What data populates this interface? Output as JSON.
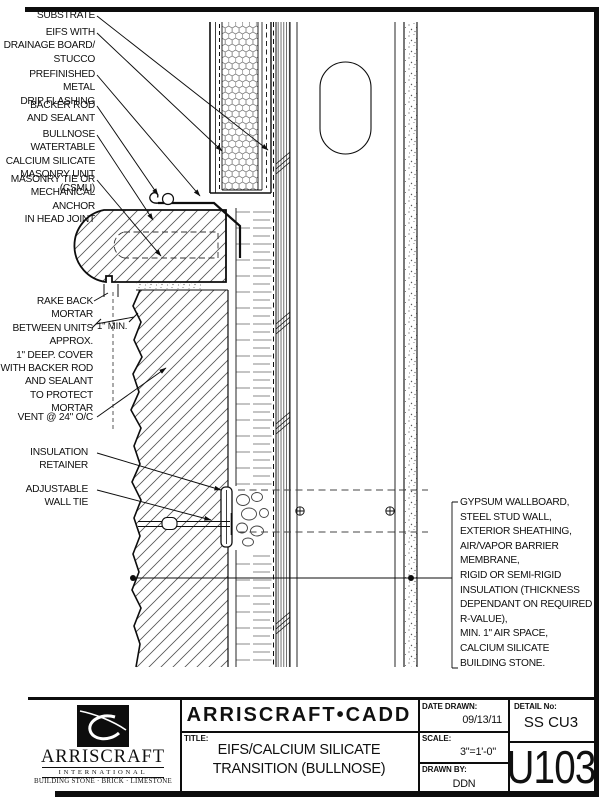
{
  "colors": {
    "ink": "#0d0d0d",
    "paper": "#ffffff",
    "hatch": "#555555"
  },
  "callouts": {
    "substrate": "SUBSTRATE",
    "eifs": "EIFS WITH\nDRAINAGE BOARD/\nSTUCCO",
    "drip_flashing": "PREFINISHED METAL\nDRIP FLASHING",
    "backer_rod": "BACKER ROD\nAND SEALANT",
    "bullnose": "BULLNOSE WATERTABLE\nCALCIUM SILICATE\nMASONRY UNIT (CSMU)",
    "masonry_tie": "MASONRY TIE OR\nMECHANICAL ANCHOR\nIN HEAD JOINT",
    "rake_mortar": "RAKE BACK MORTAR\nBETWEEN UNITS APPROX.\n1\" DEEP.  COVER\nWITH BACKER ROD\nAND SEALANT\nTO PROTECT MORTAR",
    "dim_min": "1\" MIN.",
    "vent": "VENT @ 24\" O/C",
    "insulation_retainer": "INSULATION\nRETAINER",
    "wall_tie": "ADJUSTABLE\nWALL TIE",
    "wall_assembly_note": "GYPSUM WALLBOARD,\nSTEEL STUD WALL,\nEXTERIOR SHEATHING,\nAIR/VAPOR BARRIER\nMEMBRANE,\nRIGID OR SEMI-RIGID\nINSULATION (THICKNESS\nDEPENDANT ON REQUIRED\nR-VALUE),\nMIN. 1\" AIR SPACE,\nCALCIUM SILICATE\nBUILDING STONE."
  },
  "title_block": {
    "brand": "ARRISCRAFT•CADD",
    "title_label": "TITLE:",
    "title": "EIFS/CALCIUM SILICATE\nTRANSITION (BULLNOSE)",
    "date_label": "DATE DRAWN:",
    "date_value": "09/13/11",
    "scale_label": "SCALE:",
    "scale_value": "3\"=1'-0\"",
    "drawn_label": "DRAWN BY:",
    "drawn_value": "DDN",
    "detail_label": "DETAIL No:",
    "detail_value": "SS CU3",
    "sheet_number": "U103"
  },
  "logo": {
    "name": "ARRISCRAFT",
    "subtitle": "INTERNATIONAL",
    "tagline": "BUILDING STONE · BRICK · LIMESTONE"
  }
}
